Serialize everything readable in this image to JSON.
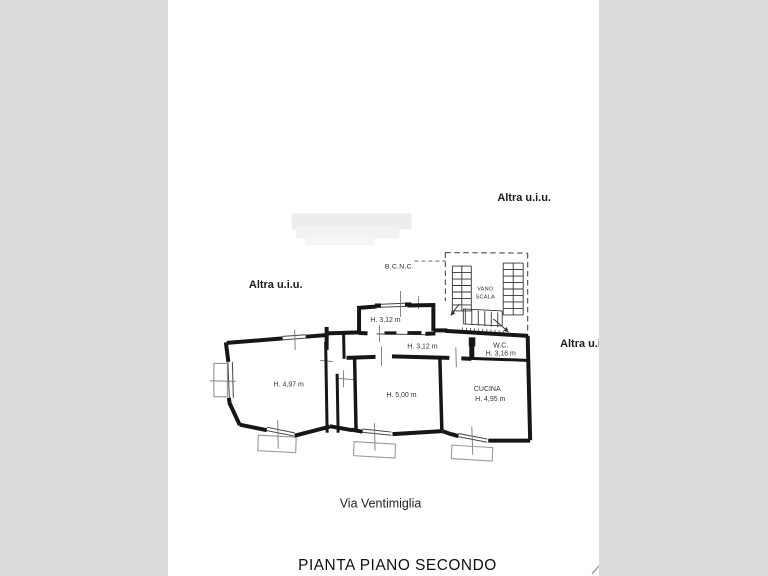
{
  "viewer": {
    "background_color": "#dcdcdd",
    "paper_color": "#ffffff",
    "ink_color": "#161616"
  },
  "plan": {
    "title": "PIANTA PIANO SECONDO",
    "street": "Via Ventimiglia",
    "adjacent_units": {
      "top_right": "Altra u.i.u.",
      "left": "Altra u.i.u.",
      "right": "Altra u.i.u."
    },
    "common_areas": {
      "bcnc": "B.C.N.C.",
      "stairwell_line1": "VANO",
      "stairwell_line2": "SCALA"
    },
    "rooms": {
      "top_room_height": "H. 3,12 m",
      "hallway_height": "H. 3,12 m",
      "wc_name": "W.C.",
      "wc_height": "H. 3,16 m",
      "left_room_height": "H. 4,97 m",
      "middle_room_height": "H. 5,00 m",
      "kitchen_name": "CUCINA",
      "kitchen_height": "H. 4,95 m"
    }
  }
}
